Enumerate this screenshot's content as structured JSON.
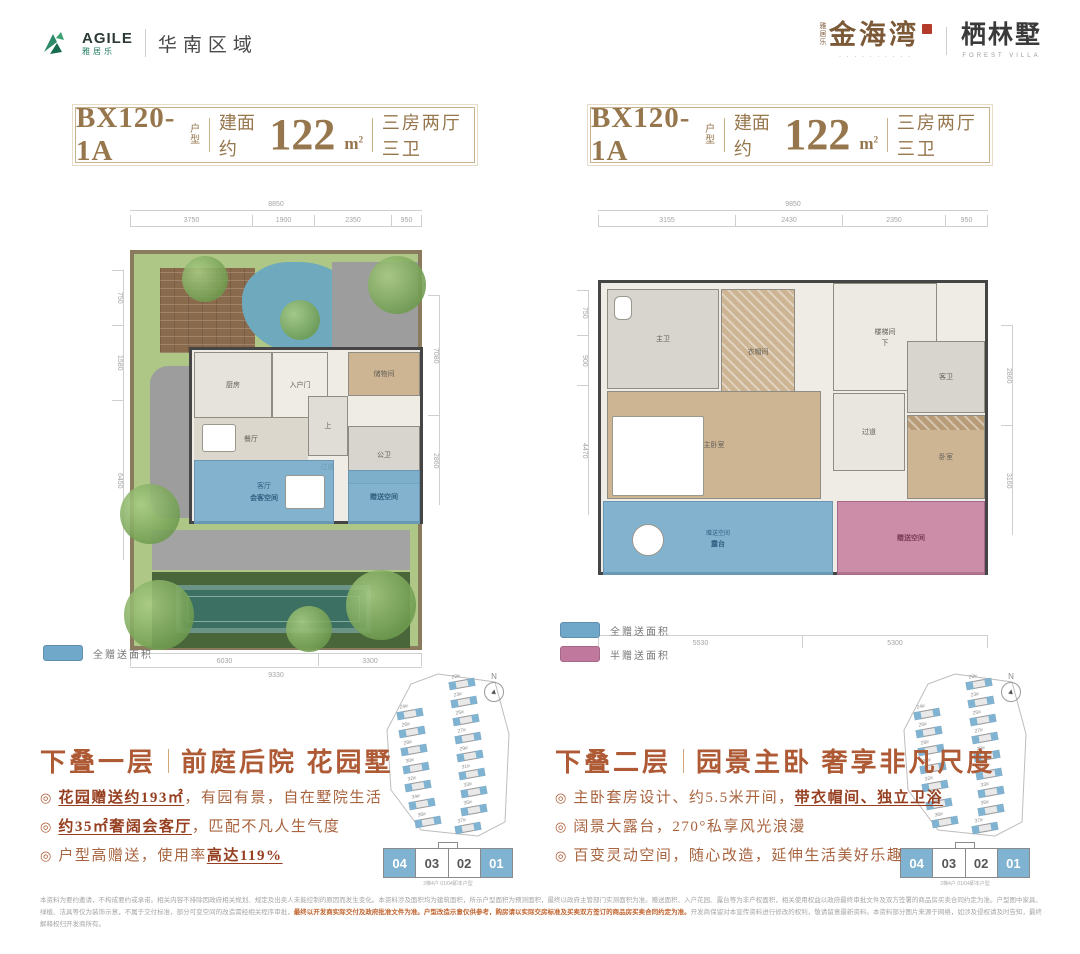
{
  "brand": {
    "agile_en": "AGILE",
    "agile_cn": "雅居乐",
    "region": "华南区域",
    "project_prefix": "雅居乐",
    "project_name": "金海湾",
    "project_tagline": "· · · · · · · · · ·",
    "villa_name": "栖林墅",
    "villa_en": "FOREST VILLA"
  },
  "bullet_marker": "◎",
  "colors": {
    "accent_gold": "#96764c",
    "title_red": "#ad5a35",
    "gift_blue": "#6fa8c9",
    "gift_pink": "#c0789c",
    "agile_green": "#1d7a5f"
  },
  "panels": [
    {
      "header": {
        "model": "BX120-1A",
        "model_tag": "户型",
        "area_label": "建面约",
        "area_value": "122",
        "area_unit": "m",
        "area_sup": "2",
        "rooms_label": "三房两厅三卫"
      },
      "plan": {
        "dims_top_total": "8850",
        "dims_top": [
          "3750",
          "1900",
          "2350",
          "950"
        ],
        "dims_left": [
          "750",
          "1580",
          "6450"
        ],
        "dims_right": [
          "7080",
          "2860"
        ],
        "dims_bottom": [
          "6030",
          "3300"
        ],
        "dims_bottom_total": "9330",
        "rooms": {
          "kitchen": "厨房",
          "entry": "入户门",
          "storage": "储物间",
          "dining": "餐厅",
          "living": "客厅",
          "bath": "公卫",
          "hall": "过道",
          "stair": "上",
          "gift_living": "会客空间",
          "gift_room": "赠送空间"
        }
      },
      "legend": [
        {
          "label": "全赠送面积"
        }
      ],
      "sitemap": {
        "compass": "N",
        "buildings_left": [
          "24#",
          "26#",
          "28#",
          "30#",
          "32#",
          "34#",
          "36#"
        ],
        "buildings_right": [
          "22#",
          "23#",
          "25#",
          "27#",
          "29#",
          "31#",
          "33#",
          "35#",
          "37#"
        ],
        "units": [
          "04",
          "03",
          "02",
          "01"
        ],
        "caption": "2梯4户 01/04即本户型"
      },
      "title": {
        "main": "下叠一层",
        "sub": "前庭后院 花园墅"
      },
      "bullets": [
        {
          "pre": "",
          "strong": "花园赠送约193㎡",
          "post": "，有园有景，自在墅院生活"
        },
        {
          "pre": "",
          "strong": "约35㎡奢阔会客厅",
          "post": "，匹配不凡人生气度"
        },
        {
          "pre": "户型高赠送，使用率",
          "strong": "高达119%",
          "post": ""
        }
      ]
    },
    {
      "header": {
        "model": "BX120-1A",
        "model_tag": "户型",
        "area_label": "建面约",
        "area_value": "122",
        "area_unit": "m",
        "area_sup": "2",
        "rooms_label": "三房两厅三卫"
      },
      "plan": {
        "dims_top_total": "9850",
        "dims_top": [
          "3155",
          "2430",
          "2350",
          "950"
        ],
        "dims_left": [
          "750",
          "900",
          "4470"
        ],
        "dims_right": [
          "2860",
          "3160"
        ],
        "dims_bottom": [
          "5530",
          "5300"
        ],
        "rooms": {
          "master_bath": "主卫",
          "closet": "衣帽间",
          "stairs": "楼梯间",
          "stairs_down": "下",
          "hall": "过道",
          "guest_bath": "客卫",
          "bedroom": "卧室",
          "master": "主卧室",
          "terrace": "露台",
          "terrace_tag": "赠送空间",
          "pink_room": "赠送空间"
        }
      },
      "legend": [
        {
          "label": "全赠送面积"
        },
        {
          "label": "半赠送面积"
        }
      ],
      "sitemap": {
        "compass": "N",
        "buildings_left": [
          "24#",
          "26#",
          "28#",
          "30#",
          "32#",
          "34#",
          "36#"
        ],
        "buildings_right": [
          "22#",
          "23#",
          "25#",
          "27#",
          "29#",
          "31#",
          "33#",
          "35#",
          "37#"
        ],
        "units": [
          "04",
          "03",
          "02",
          "01"
        ],
        "caption": "2梯4户 01/04即本户型"
      },
      "title": {
        "main": "下叠二层",
        "sub": "园景主卧 奢享非凡尺度"
      },
      "bullets": [
        {
          "pre": "主卧套房设计、约5.5米开间，",
          "strong": "带衣帽间、独立卫浴",
          "post": ""
        },
        {
          "pre": "阔景大露台，270°私享风光浪漫",
          "strong": "",
          "post": ""
        },
        {
          "pre": "百变灵动空间，随心改造，延伸生活美好乐趣",
          "strong": "",
          "post": ""
        }
      ]
    }
  ],
  "disclaimer": {
    "gray1": "本资料为要约邀请，不构成要约或承诺。相关内容不排除因政府相关规划、规定及出卖人未能控制的原因而发生变化。本资料涉及面积均为建筑面积，所示户型面积为预测面积，最终以政府主管部门实测面积为准。赠送面积、入户花园、露台等为非产权面积，相关使用权益以政府最终审批文件及双方签署的商品房买卖合同约定为准。户型图中家具、绿植、洁具等仅为装饰示意，不属于交付标准，部分可变空间的改造需经相关程序审批，",
    "orange": "最终以开发商实际交付及政府批准文件为准。户型改造示意仅供参考，购房请以实际交房标准及买卖双方签订的商品房买卖合同约定为准。",
    "gray2": "开发商保留对本宣传资料进行修改的权利，敬请留意最新资料。本资料部分图片来源于网络，如涉及侵权请及时告知，最终解释权归开发商所有。"
  }
}
